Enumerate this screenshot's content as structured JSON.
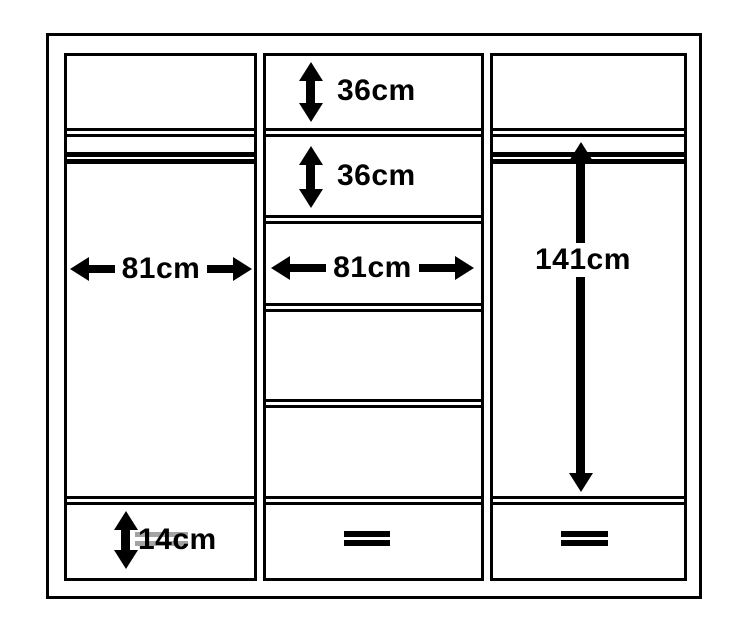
{
  "diagram": {
    "colors": {
      "line": "#000000",
      "background": "#ffffff",
      "handle_gray": "#a3a3a3"
    },
    "icons": {
      "drawer_handle": "double-bar-handle",
      "hanging_rail": "double-rail-line",
      "dimension_arrow": "double-headed-arrow"
    },
    "dimensions": {
      "middle_top_shelf_height": "36cm",
      "middle_second_shelf_height": "36cm",
      "left_section_width": "81cm",
      "middle_section_width": "81cm",
      "right_hanging_height": "141cm",
      "left_drawer_height": "14cm"
    }
  }
}
